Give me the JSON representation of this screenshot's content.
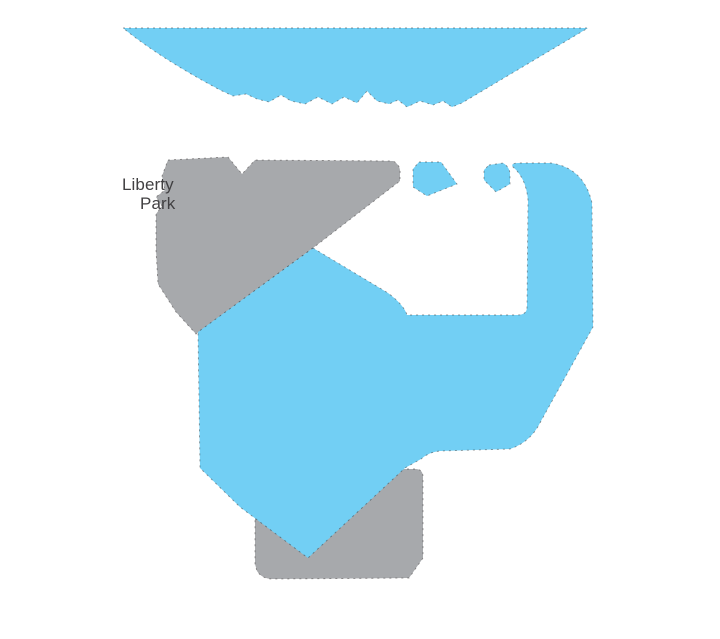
{
  "canvas": {
    "width": 720,
    "height": 639,
    "background_color": "#FFFFFF"
  },
  "illustration": {
    "description": "Stylized flat map illustration fragment: light-blue water bodies (large lake with jagged south shoreline, hooked river channel, central lake, two small ponds) and gray land parcels, with a partially overlapped park label.",
    "palette": {
      "water_blue": "#72CFF4",
      "land_gray": "#A7A9AC",
      "label_color": "#414042",
      "edge_dash_color": "#231F20"
    },
    "label": {
      "line1": "Liberty",
      "line2": "Park"
    },
    "shapes": [
      {
        "name": "lake-top",
        "kind": "water",
        "fill": "#72CFF4",
        "path": "M123,28 L588,28 L462,103 L452,107 L443,101 L433,105 L420,101 L407,107 L398,100 L389,104 L377,101 L367,91 L357,103 L344,97 L332,104 L318,97 L305,104 L291,101 L281,95 L269,102 L257,99 L246,94 L233,96 L220,90 Q160,58 123,28 Z"
      },
      {
        "name": "land-parcel-left",
        "kind": "land",
        "fill": "#A7A9AC",
        "path": "M168,160 L228,157 L242,174 L255,160 L393,161 Q401,165 400,174 L400,181 L313,248 L196,334 L176,312 L158,284 L156,250 L156,214 L162,206 L156,197 L165,190 L162,176 Z"
      },
      {
        "name": "land-parcel-bottom",
        "kind": "land",
        "fill": "#A7A9AC",
        "path": "M263,469 L415,469 Q423,469 423,477 L423,558 L409,578 L273,579 Q262,579 257,571 L255,564 L255,477 Q255,469 263,469 Z"
      },
      {
        "name": "river-swoosh",
        "kind": "water",
        "fill": "#72CFF4",
        "path": "M313,248 L388,293 Q404,305 407,315 L517,315 Q527,315 527,307 L528,200 Q526,178 513,167 Q510,163 519,163 L551,163 Q584,168 592,203 L593,327 L541,421 Q531,442 510,449 L440,451 Q429,452 421,459 L405,468 L308,558 L240,507 L200,468 L198,332 Z"
      },
      {
        "name": "pond-small-left",
        "kind": "water",
        "fill": "#72CFF4",
        "path": "M419,162 L441,162 L457,184 L427,196 L413,187 L413,169 Z"
      },
      {
        "name": "pond-small-right",
        "kind": "water",
        "fill": "#72CFF4",
        "path": "M489,165 L503,163 Q510,167 510,175 L510,184 L496,192 L484,180 L484,170 Z"
      }
    ]
  }
}
